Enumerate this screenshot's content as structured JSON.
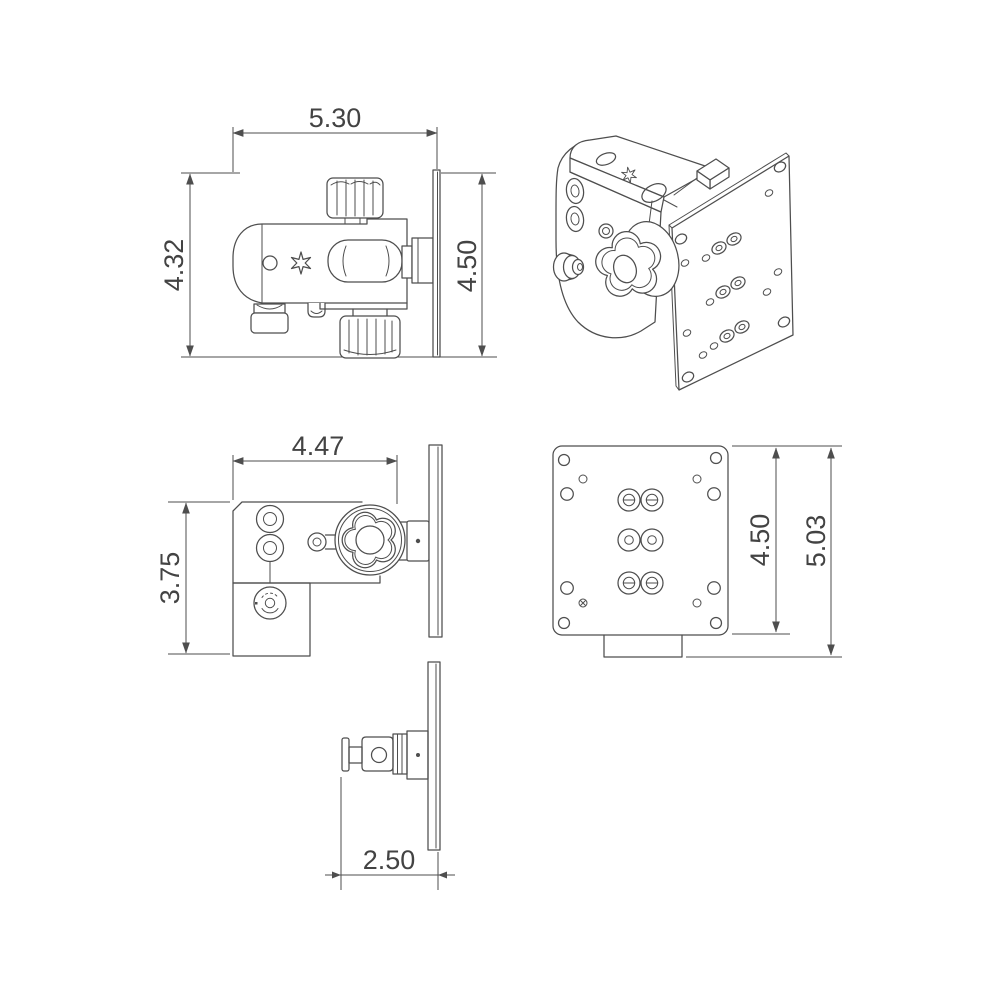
{
  "drawing": {
    "type": "technical-drawing",
    "background": "#ffffff",
    "line_color": "#4e4e4e",
    "text_color": "#434343",
    "views": {
      "side": {
        "name": "side-view-with-knobs",
        "dim_width": "5.30",
        "dim_overall_height": "4.32",
        "dim_plate_height": "4.50"
      },
      "isometric": {
        "name": "isometric-view"
      },
      "top": {
        "name": "top-view-with-star-knob",
        "dim_depth": "4.47",
        "dim_body_height": "3.75"
      },
      "plate": {
        "name": "mounting-plate-front-view",
        "dim_inner_height": "4.50",
        "dim_overall_height": "5.03"
      },
      "bottom": {
        "name": "bottom-view-with-stud",
        "dim_offset": "2.50"
      }
    }
  }
}
